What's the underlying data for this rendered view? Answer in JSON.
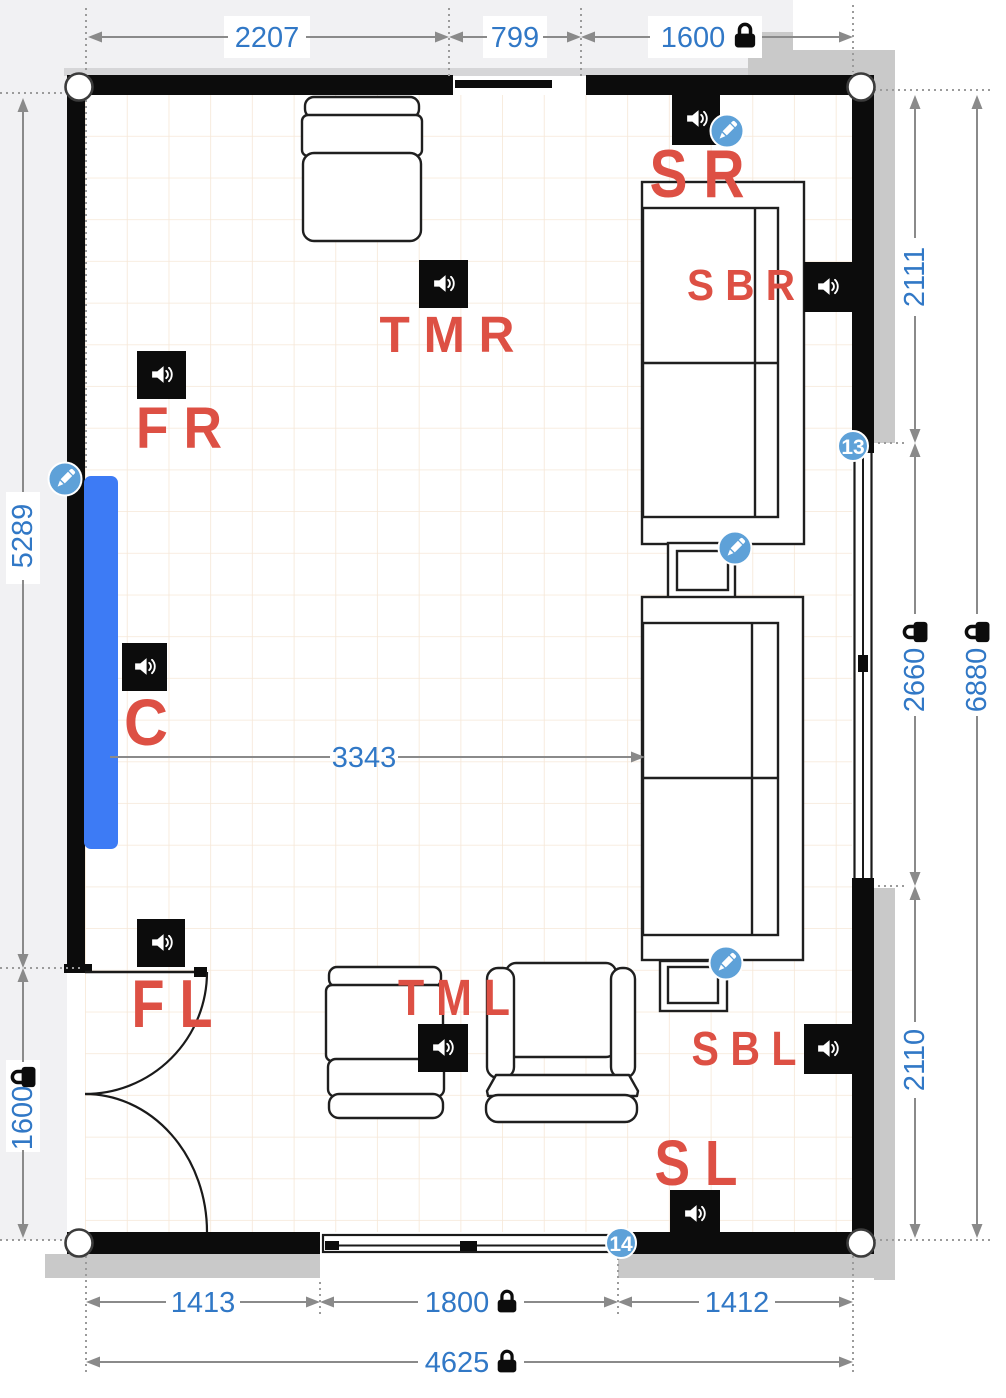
{
  "app": {
    "title": "Room speaker layout floor plan"
  },
  "speakers": {
    "sr": {
      "label": "S R"
    },
    "sbr": {
      "label": "S B R"
    },
    "tmr": {
      "label": "T M R"
    },
    "fr": {
      "label": "F R"
    },
    "c": {
      "label": "C"
    },
    "fl": {
      "label": "F L"
    },
    "tml": {
      "label": "T M L"
    },
    "sbl": {
      "label": "S B L"
    },
    "sl": {
      "label": "S L"
    }
  },
  "dimensions": {
    "top_left": "2207",
    "top_middle": "799",
    "top_right": "1600",
    "left_upper": "5289",
    "left_lower": "1600",
    "right_upper": "2111",
    "right_middle": "2660",
    "right_lower": "2110",
    "right_total": "6880",
    "bottom_left": "1413",
    "bottom_middle": "1800",
    "bottom_right": "1412",
    "bottom_total": "4625",
    "center_distance": "3343"
  },
  "locks": {
    "top_right": true,
    "left_lower": true,
    "right_middle": true,
    "right_total": true,
    "bottom_middle": true,
    "bottom_total": true
  },
  "badges": {
    "right_window": "13",
    "bottom_window": "14"
  },
  "colors": {
    "dimension_text": "#3178c6",
    "speaker_label": "#dd5044",
    "badge_blue": "#5ea1d8",
    "screen_blue": "#3d7bf5",
    "wall": "#0c0c0c",
    "grid": "#f6e7d7",
    "exterior_band": "#c9c9c9",
    "dimension_line": "#8a8a8a"
  }
}
